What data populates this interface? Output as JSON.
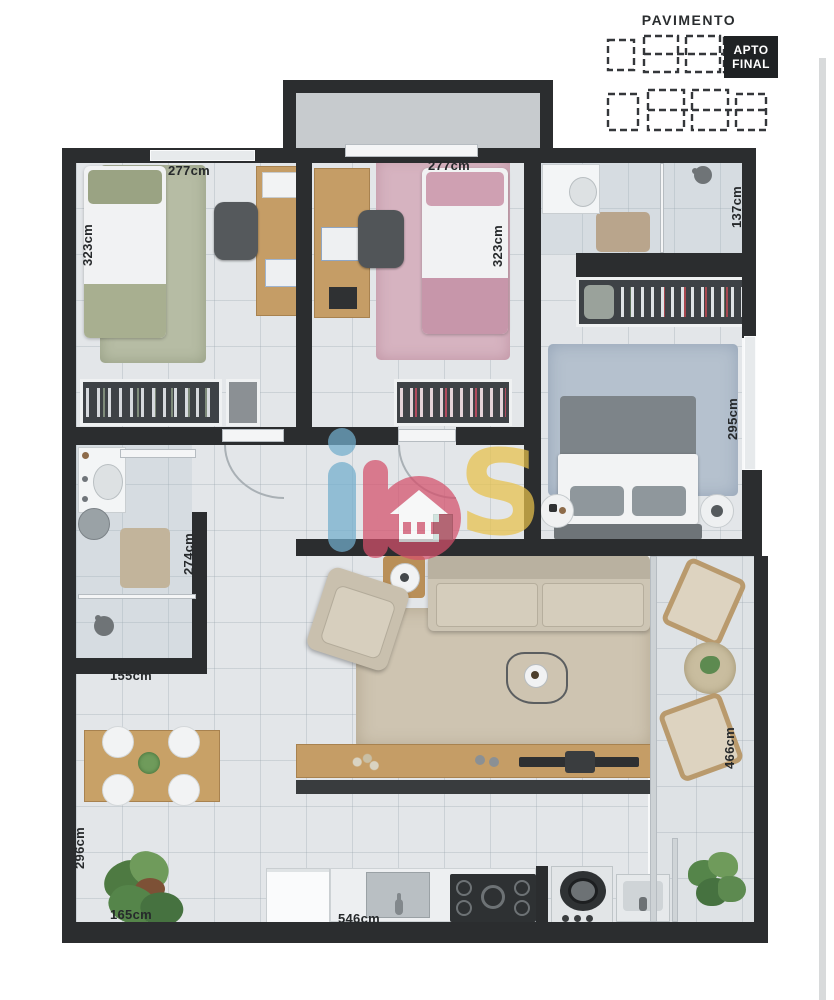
{
  "legend": {
    "title": "PAVIMENTO",
    "badge": {
      "line1": "APTO",
      "line2": "FINAL"
    }
  },
  "watermark": {
    "brand": "ibs",
    "letter_s": "S",
    "colors": {
      "i": "#72aecd",
      "b": "#d5506b",
      "s": "#e8c24b"
    }
  },
  "dimensions": [
    {
      "name": "bedroom1-width",
      "text": "277cm",
      "orientation": "horizontal"
    },
    {
      "name": "bedroom1-depth",
      "text": "323cm",
      "orientation": "vertical"
    },
    {
      "name": "bedroom2-width",
      "text": "277cm",
      "orientation": "horizontal"
    },
    {
      "name": "bedroom2-depth",
      "text": "323cm",
      "orientation": "vertical"
    },
    {
      "name": "bathroom1-depth",
      "text": "137cm",
      "orientation": "vertical"
    },
    {
      "name": "master-depth",
      "text": "295cm",
      "orientation": "vertical"
    },
    {
      "name": "bathroom2-depth",
      "text": "274cm",
      "orientation": "vertical"
    },
    {
      "name": "bathroom2-width",
      "text": "155cm",
      "orientation": "horizontal"
    },
    {
      "name": "dining-depth",
      "text": "296cm",
      "orientation": "vertical"
    },
    {
      "name": "dining-width",
      "text": "165cm",
      "orientation": "horizontal"
    },
    {
      "name": "balcony-depth",
      "text": "466cm",
      "orientation": "vertical"
    },
    {
      "name": "kitchen-width",
      "text": "546cm",
      "orientation": "horizontal"
    }
  ],
  "colors": {
    "wall": "#2b2d2f",
    "floor": "#e3e6e9",
    "vestibule_floor": "#c7cbce",
    "badge_bg": "#1f2224",
    "wood": "#c59d66",
    "rug_bedroom1": "#b6bca4",
    "rug_bedroom2": "#d6b3c0",
    "rug_master": "#b5c1ce",
    "rug_living": "#cec4b1",
    "label": "#26292b"
  }
}
